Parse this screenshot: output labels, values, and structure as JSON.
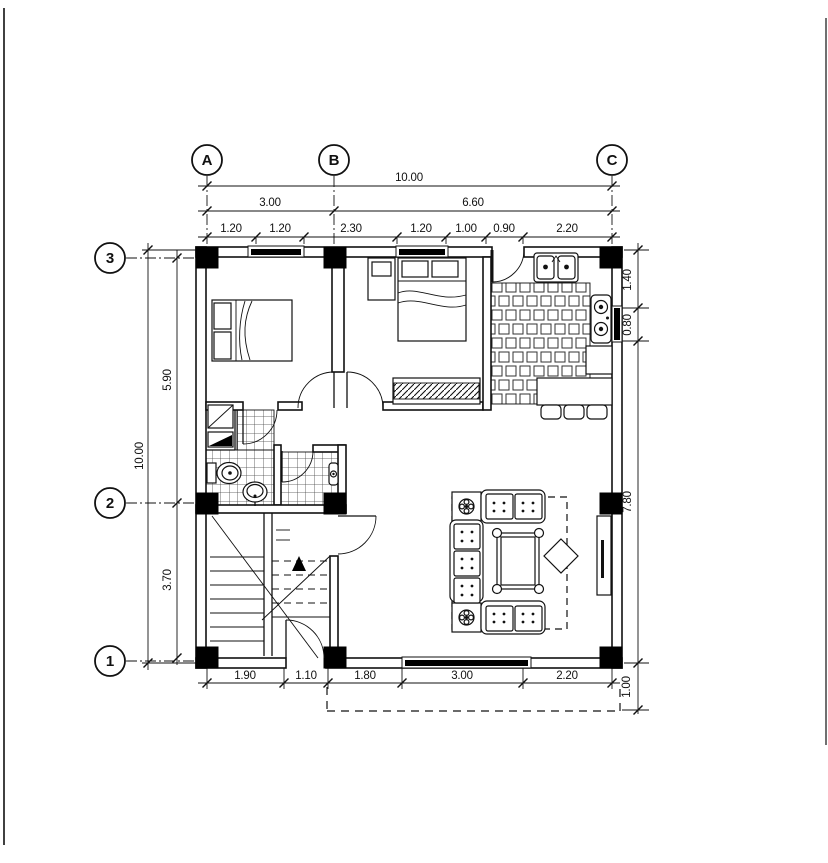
{
  "page": {
    "paper_color": "#ffffff",
    "ink_color": "#111111"
  },
  "grid_axes": {
    "column_labels": [
      "A",
      "B",
      "C"
    ],
    "row_labels": [
      "3",
      "2",
      "1"
    ]
  },
  "dimensions": {
    "top": {
      "overall": "10.00",
      "spans": [
        "3.00",
        "6.60"
      ],
      "segments": [
        "1.20",
        "1.20",
        "2.30",
        "1.20",
        "1.00",
        "0.90",
        "2.20"
      ]
    },
    "bottom": {
      "segments": [
        "1.90",
        "1.10",
        "1.80",
        "3.00",
        "2.20"
      ]
    },
    "left": {
      "overall": "10.00",
      "segments": [
        "5.90",
        "3.70"
      ]
    },
    "right": {
      "segments": [
        "1.40",
        "0.80",
        "7.80"
      ],
      "porch_offset": "1.00"
    }
  }
}
